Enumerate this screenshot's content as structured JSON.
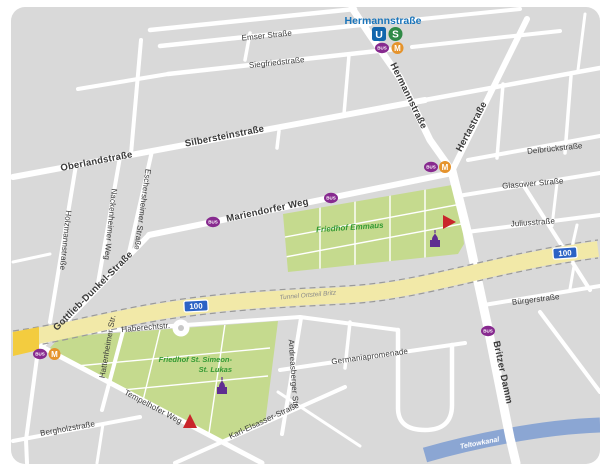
{
  "map": {
    "station": {
      "name": "Hermannstraße",
      "u": "U",
      "s": "S"
    },
    "transit": {
      "bus_label": "BUS",
      "m_label": "M"
    },
    "route_shield": "100",
    "streets": {
      "emser": "Emser Straße",
      "siegfried": "Siegfriedstraße",
      "silberstein": "Silbersteinstraße",
      "oberland": "Oberlandstraße",
      "mariendorfer": "Mariendorfer Weg",
      "hermann": "Hermannstraße",
      "herta": "Hertastraße",
      "delbrueck": "Delbrückstraße",
      "glasower": "Glasower Straße",
      "julius": "Juliusstraße",
      "buerger": "Bürgerstraße",
      "britzer": "Britzer Damm",
      "gottlieb": "Gottlieb-Dunkel-Straße",
      "holzmann": "Holzmannstraße",
      "nackenheimer": "Nackenheimer Weg",
      "eschersheimer": "Eschersheimer Straße",
      "haberecht": "Haberechtstr.",
      "hattenheimer": "Hattenheimer Str.",
      "tempelhofer": "Tempelhofer Weg",
      "bergholz": "Bergholzstraße",
      "karl_elsasser": "Karl-Elsasser-Straße",
      "andreasberger": "Andreasberger Str.",
      "germania": "Germaniapromenade"
    },
    "places": {
      "friedhof_emmaus": "Friedhof Emmaus",
      "friedhof_simeon_1": "Friedhof St. Simeon-",
      "friedhof_simeon_2": "St. Lukas",
      "tunnel": "Tunnel Ortsteil Britz",
      "teltowkanal": "Teltowkanal"
    },
    "colors": {
      "map_bg": "#d9d9d9",
      "street": "#ffffff",
      "green_area": "#c5da8e",
      "green_text": "#339933",
      "motorway_band": "#f2e9a8",
      "motorway_entry": "#f3cc3f",
      "shield_blue": "#2b62c5",
      "canal": "#8ba6d3",
      "ubahn_blue": "#1166ad",
      "sbahn_green": "#2f8a46",
      "bus_purple": "#872a8f",
      "metro_orange": "#e5932c",
      "station_title_blue": "#1a75bb",
      "poi_purple": "#5f2d91",
      "poi_red": "#c9252b"
    }
  }
}
